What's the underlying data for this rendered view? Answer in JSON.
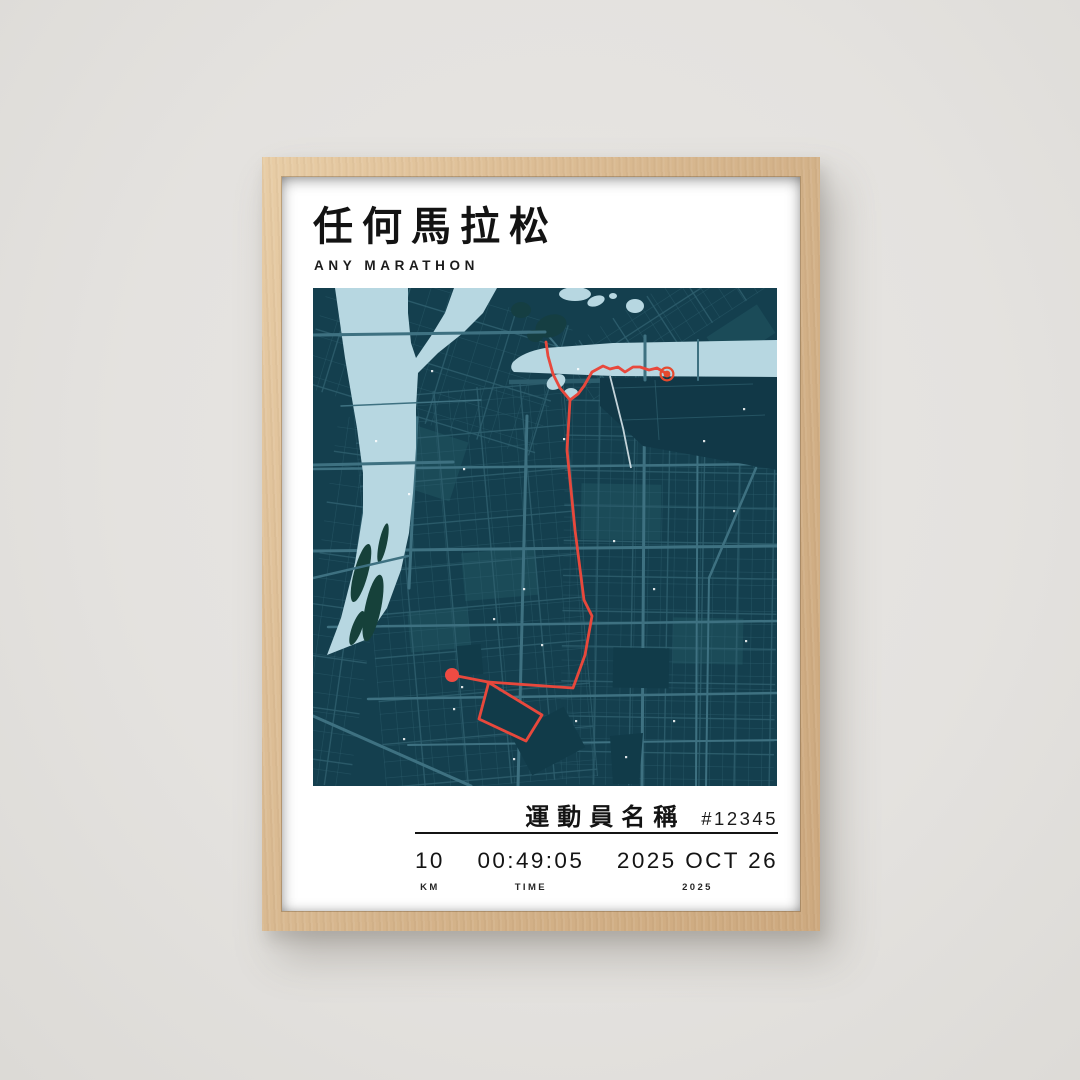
{
  "poster": {
    "title_cjk": "任何馬拉松",
    "title_latin": "ANY MARATHON",
    "athlete": {
      "name_cjk": "運動員名稱",
      "bib": "#12345"
    },
    "stats": [
      {
        "value": "10",
        "label": "KM"
      },
      {
        "value": "00:49:05",
        "label": "TIME"
      },
      {
        "value": "2025 OCT 26",
        "label": "2025"
      }
    ]
  },
  "map": {
    "colors": {
      "bg": "#143F4E",
      "street": "#2E5F6E",
      "street_major": "#3E7181",
      "highway": "#2C5D6C",
      "water": "#B7D7E1",
      "island": "#16413A",
      "park": "#153E42",
      "harbor": "#113847",
      "block_light": "#1C4C5A",
      "block_dark": "#113B49",
      "rail": "#D7E4EA",
      "speck": "#FFFFFF",
      "route": "#E8483C",
      "start": "#EE4B43",
      "finish": "#E64A2E"
    },
    "route": {
      "start_leg": [
        [
          139,
          387
        ],
        [
          175,
          394
        ]
      ],
      "loop": [
        [
          175,
          394
        ],
        [
          229,
          427
        ],
        [
          213,
          453
        ],
        [
          166,
          431
        ],
        [
          175,
          397
        ]
      ],
      "main": [
        [
          175,
          394
        ],
        [
          260,
          400
        ],
        [
          272,
          367
        ],
        [
          279,
          328
        ],
        [
          271,
          312
        ],
        [
          262,
          242
        ],
        [
          254,
          162
        ],
        [
          257,
          112
        ]
      ],
      "spur": [
        [
          257,
          112
        ],
        [
          247,
          100
        ],
        [
          240,
          86
        ],
        [
          235,
          68
        ],
        [
          233,
          54
        ]
      ],
      "finish_leg": [
        [
          257,
          112
        ],
        [
          265,
          106
        ],
        [
          271,
          98
        ],
        [
          279,
          84
        ],
        [
          290,
          78
        ],
        [
          297,
          81
        ],
        [
          305,
          79
        ],
        [
          312,
          84
        ],
        [
          320,
          79
        ],
        [
          327,
          79
        ],
        [
          336,
          82
        ],
        [
          344,
          80
        ],
        [
          354,
          86
        ]
      ]
    },
    "markers": {
      "start": {
        "x": 139,
        "y": 387,
        "r": 7
      },
      "finish": {
        "x": 354,
        "y": 86,
        "r": 3.4,
        "ring_r": 6.4
      }
    }
  }
}
